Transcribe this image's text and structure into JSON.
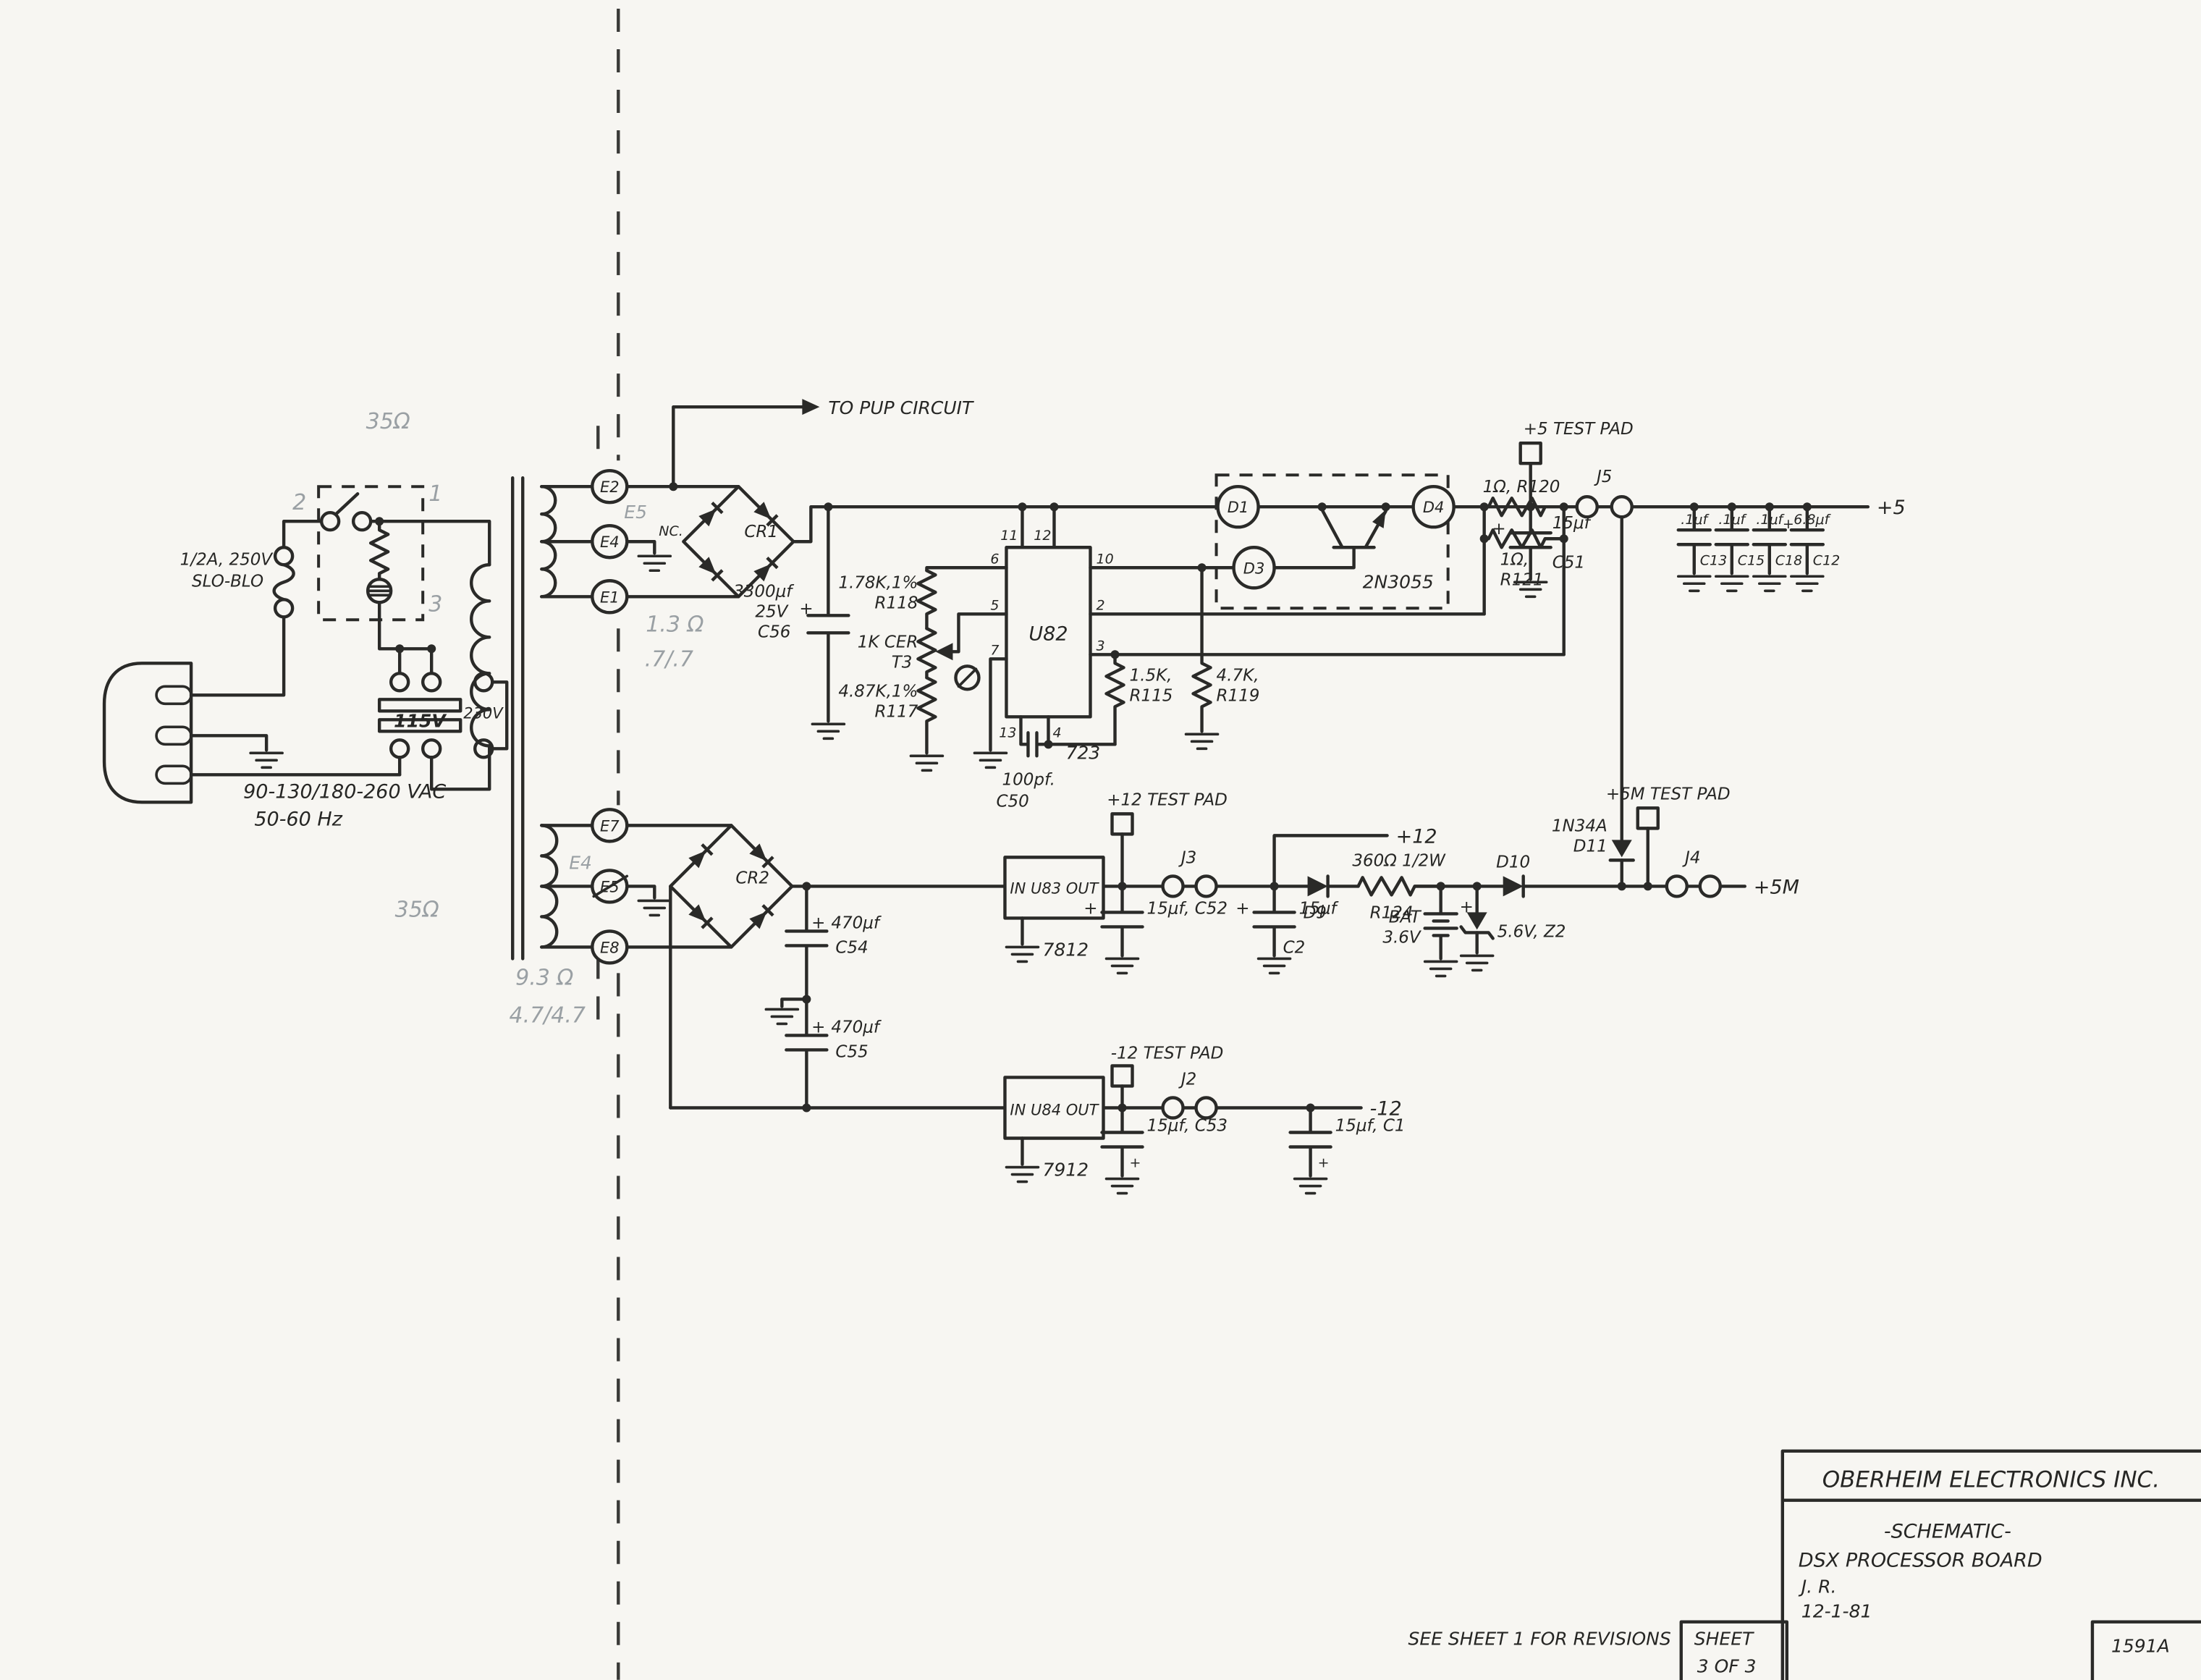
{
  "colors": {
    "ink": "#2a2a28",
    "pencil": "#9aa0a4",
    "paper": "#f7f6f2"
  },
  "sym": {
    "plus": "+"
  },
  "ac": {
    "vac": "90-130/180-260 VAC",
    "hz": "50-60 Hz",
    "fuse1": "1/2A, 250V",
    "fuse2": "SLO-BLO",
    "v115": "115V",
    "v230": "230V"
  },
  "pencil_notes": {
    "r35_top": "35Ω",
    "r35_bot": "35Ω",
    "sw2": "2",
    "sw1": "1",
    "sw3": "3",
    "e5": "E5",
    "e4": "E4",
    "r13": "1.3 Ω",
    "r77": ".7/.7",
    "r93": "9.3 Ω",
    "r4747": "4.7/4.7"
  },
  "xfmr": {
    "e2": "E2",
    "e4": "E4",
    "e1": "E1",
    "e7": "E7",
    "e5": "E5",
    "e8": "E8",
    "nc": "NC."
  },
  "cr1": "CR1",
  "cr2": "CR2",
  "pup": "TO PUP CIRCUIT",
  "c56": {
    "v": "3300μf",
    "volt": "25V",
    "name": "C56"
  },
  "u82": {
    "name": "U82",
    "type": "723",
    "p11": "11",
    "p12": "12",
    "p6": "6",
    "p5": "5",
    "p7": "7",
    "p10": "10",
    "p2": "2",
    "p3": "3",
    "p13": "13",
    "p4": "4"
  },
  "r118": {
    "v": "1.78K,1%",
    "name": "R118"
  },
  "t3": {
    "v": "1K CER",
    "name": "T3"
  },
  "r117": {
    "v": "4.87K,1%",
    "name": "R117"
  },
  "r115": {
    "v": "1.5K,",
    "name": "R115"
  },
  "r119": {
    "v": "4.7K,",
    "name": "R119"
  },
  "c50": {
    "v": "100pf.",
    "name": "C50"
  },
  "pass": {
    "d1": "D1",
    "d3": "D3",
    "d4": "D4",
    "q": "2N3055"
  },
  "r120": "1Ω, R120",
  "r121": {
    "v": "1Ω,",
    "name": "R121"
  },
  "tp5": "+5 TEST PAD",
  "j5": "J5",
  "c51": {
    "v": "15μf",
    "name": "C51"
  },
  "railcaps": {
    "c13v": ".1μf",
    "c15v": ".1μf",
    "c18v": ".1μf",
    "c12v": "6.8μf",
    "c13": "C13",
    "c15": "C15",
    "c18": "C18",
    "c12": "C12"
  },
  "out5": "+5",
  "tp12": "+12 TEST PAD",
  "u83": {
    "label": "IN U83 OUT",
    "type": "7812"
  },
  "c52": {
    "v": "15μf, C52"
  },
  "j3": "J3",
  "out12": "+12",
  "c2": {
    "v": "15μf",
    "name": "C2"
  },
  "d9": "D9",
  "r124": {
    "v": "360Ω 1/2W",
    "name": "R124"
  },
  "bat": {
    "name": "BAT",
    "v": "3.6V"
  },
  "z2": "5.6V, Z2",
  "d10": "D10",
  "d11": {
    "type": "1N34A",
    "name": "D11"
  },
  "tp5m": "+5M TEST PAD",
  "j4": "J4",
  "out5m": "+5M",
  "c54": {
    "v": "470μf",
    "name": "C54"
  },
  "c55": {
    "v": "470μf",
    "name": "C55"
  },
  "tpm12": "-12 TEST PAD",
  "u84": {
    "label": "IN U84 OUT",
    "type": "7912"
  },
  "c53": {
    "v": "15μf, C53"
  },
  "j2": "J2",
  "c1": {
    "v": "15μf, C1"
  },
  "outm12": "-12",
  "title": {
    "company": "OBERHEIM ELECTRONICS INC.",
    "doc": "-SCHEMATIC-",
    "board": "DSX  PROCESSOR  BOARD",
    "by": "J. R.",
    "date": "12-1-81",
    "rev": "SEE SHEET 1 FOR REVISIONS",
    "sheet_label": "SHEET",
    "sheet_num": "3 OF 3",
    "docnum": "1591A"
  }
}
